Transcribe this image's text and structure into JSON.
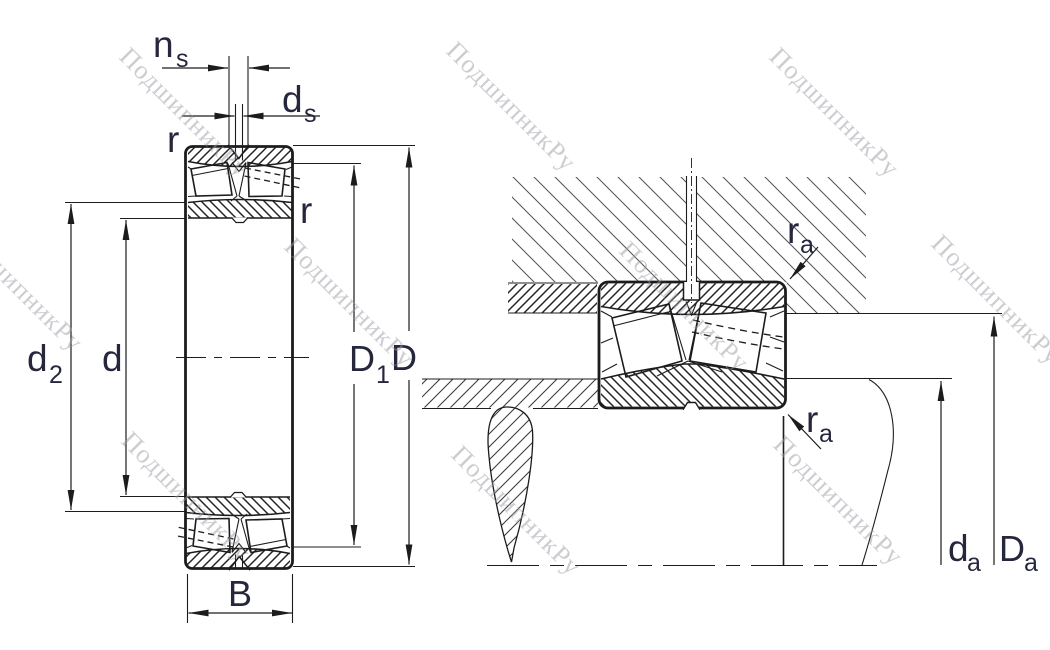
{
  "watermark": {
    "text": "ПодшипникРу"
  },
  "colors": {
    "label": "#26263c",
    "line": "#1c1c1c",
    "watermark": "#9a9aa2"
  },
  "left_view": {
    "labels": {
      "n_s": {
        "main": "n",
        "sub": "s"
      },
      "d_s": {
        "main": "d",
        "sub": "s"
      },
      "r_top": "r",
      "r_side": "r",
      "d_2": {
        "main": "d",
        "sub": "2"
      },
      "d": "d",
      "D_1": {
        "main": "D",
        "sub": "1"
      },
      "D": "D",
      "B": "B"
    }
  },
  "right_view": {
    "labels": {
      "r_a_top": {
        "main": "r",
        "sub": "a"
      },
      "r_a_bottom": {
        "main": "r",
        "sub": "a"
      },
      "d_a": {
        "main": "d",
        "sub": "a"
      },
      "D_a": {
        "main": "D",
        "sub": "a"
      }
    }
  }
}
